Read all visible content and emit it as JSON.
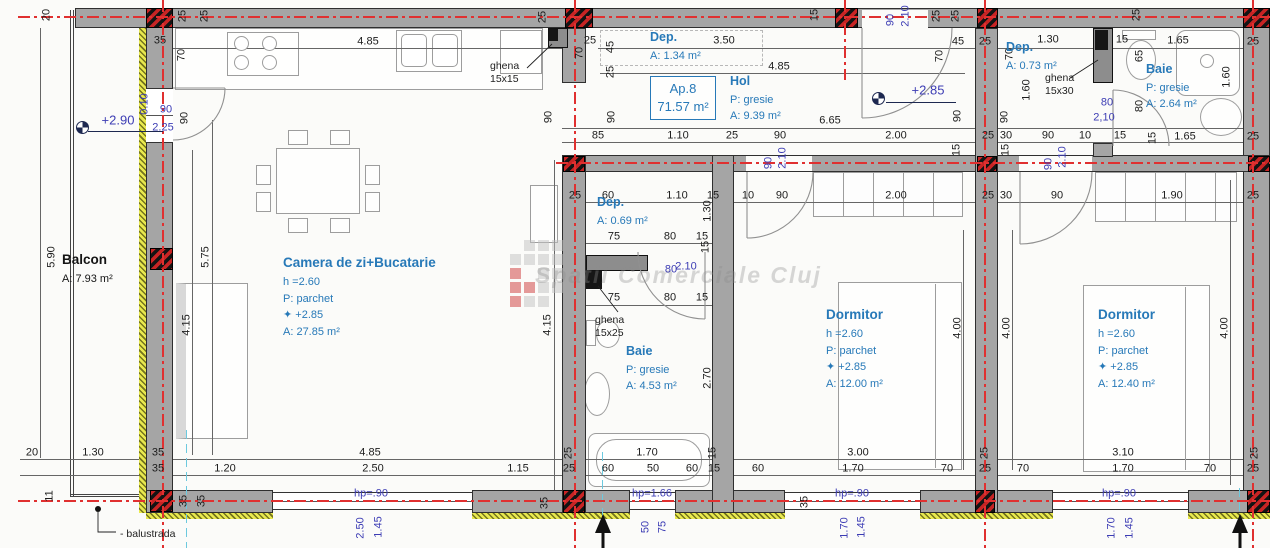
{
  "title": "Ap.8 apartment floor plan",
  "watermark": {
    "text": "Spatii Comerciale Cluj"
  },
  "ap_box": {
    "line1": "Ap.8",
    "line2": "71.57 m²"
  },
  "colors": {
    "axis_red": "#e03030",
    "annotation_blue": "#3c3cb4",
    "room_blue": "#2779b8",
    "wall_gray": "#a5a5a5",
    "insulation_yellow": "#e9e94e"
  },
  "room_blocks": [
    {
      "name": "balcon",
      "x": 62,
      "y": 250,
      "c": "blk",
      "lines": [
        "Balcon",
        "A: 7.93 m²"
      ]
    },
    {
      "name": "camera-de-zi",
      "x": 283,
      "y": 253,
      "c": "",
      "lines": [
        "Camera de zi+Bucatarie",
        "h =2.60",
        "P: parchet",
        "✦ +2.85",
        "A: 27.85 m²"
      ]
    },
    {
      "name": "dep-1",
      "x": 650,
      "y": 28,
      "c": "dep",
      "lines": [
        "Dep.",
        "A: 1.34 m²"
      ]
    },
    {
      "name": "hol",
      "x": 730,
      "y": 72,
      "c": "dep",
      "lines": [
        "Hol",
        "P: gresie",
        "A: 9.39 m²"
      ]
    },
    {
      "name": "dep-2",
      "x": 597,
      "y": 193,
      "c": "dep",
      "lines": [
        "Dep.",
        "A: 0.69 m²"
      ]
    },
    {
      "name": "baie-1",
      "x": 626,
      "y": 342,
      "c": "dep",
      "lines": [
        "Baie",
        "P: gresie",
        "A: 4.53 m²"
      ]
    },
    {
      "name": "dormitor-1",
      "x": 826,
      "y": 305,
      "c": "",
      "lines": [
        "Dormitor",
        "h =2.60",
        "P: parchet",
        "✦ +2.85",
        "A: 12.00 m²"
      ]
    },
    {
      "name": "dormitor-2",
      "x": 1098,
      "y": 305,
      "c": "",
      "lines": [
        "Dormitor",
        "h =2.60",
        "P: parchet",
        "✦ +2.85",
        "A: 12.40 m²"
      ]
    },
    {
      "name": "dep-3",
      "x": 1006,
      "y": 38,
      "c": "dep",
      "lines": [
        "Dep.",
        "A: 0.73 m²"
      ]
    },
    {
      "name": "baie-2",
      "x": 1146,
      "y": 60,
      "c": "dep",
      "lines": [
        "Baie",
        "P: gresie",
        "A: 2.64 m²"
      ]
    },
    {
      "name": "ghena-1",
      "x": 490,
      "y": 60,
      "c": "sm",
      "lines": [
        "ghena",
        "15x15"
      ]
    },
    {
      "name": "ghena-2",
      "x": 1045,
      "y": 72,
      "c": "sm",
      "lines": [
        "ghena",
        "15x30"
      ]
    },
    {
      "name": "ghena-3",
      "x": 595,
      "y": 314,
      "c": "sm",
      "lines": [
        "ghena",
        "15x25"
      ]
    },
    {
      "name": "balustrada",
      "x": 120,
      "y": 528,
      "c": "blk sm",
      "lines": [
        "- balustrada"
      ]
    }
  ],
  "labels": [
    {
      "t": "20",
      "x": 47,
      "y": 15,
      "c": "rot"
    },
    {
      "t": "25",
      "x": 183,
      "y": 16,
      "c": "rot"
    },
    {
      "t": "25",
      "x": 205,
      "y": 16,
      "c": "rot"
    },
    {
      "t": "35",
      "x": 160,
      "y": 41,
      "c": ""
    },
    {
      "t": "70",
      "x": 182,
      "y": 55,
      "c": "rot"
    },
    {
      "t": "+2.90",
      "x": 118,
      "y": 120,
      "c": "blue big"
    },
    {
      "t": "90",
      "x": 166,
      "y": 110,
      "c": "blue"
    },
    {
      "t": "2.25",
      "x": 163,
      "y": 128,
      "c": "blue"
    },
    {
      "t": "0.10",
      "x": 145,
      "y": 104,
      "c": "blue rot"
    },
    {
      "t": "90",
      "x": 185,
      "y": 118,
      "c": "rot"
    },
    {
      "t": "5.90",
      "x": 52,
      "y": 257,
      "c": "rot"
    },
    {
      "t": "5.75",
      "x": 206,
      "y": 257,
      "c": "rot"
    },
    {
      "t": "4.15",
      "x": 187,
      "y": 325,
      "c": "rot"
    },
    {
      "t": "4.15",
      "x": 548,
      "y": 325,
      "c": "rot"
    },
    {
      "t": "4.85",
      "x": 368,
      "y": 42,
      "c": ""
    },
    {
      "t": "25",
      "x": 543,
      "y": 17,
      "c": "rot"
    },
    {
      "t": "25",
      "x": 590,
      "y": 41,
      "c": ""
    },
    {
      "t": "45",
      "x": 611,
      "y": 47,
      "c": "rot"
    },
    {
      "t": "25",
      "x": 611,
      "y": 72,
      "c": "rot"
    },
    {
      "t": "70",
      "x": 580,
      "y": 53,
      "c": "rot"
    },
    {
      "t": "90",
      "x": 549,
      "y": 117,
      "c": "rot"
    },
    {
      "t": "90",
      "x": 612,
      "y": 117,
      "c": "rot"
    },
    {
      "t": "3.50",
      "x": 724,
      "y": 41,
      "c": ""
    },
    {
      "t": "4.85",
      "x": 779,
      "y": 67,
      "c": ""
    },
    {
      "t": "15",
      "x": 815,
      "y": 15,
      "c": "rot"
    },
    {
      "t": "90",
      "x": 891,
      "y": 20,
      "c": "blue rot"
    },
    {
      "t": "2.10",
      "x": 906,
      "y": 16,
      "c": "blue rot"
    },
    {
      "t": "6.65",
      "x": 830,
      "y": 121,
      "c": ""
    },
    {
      "t": "+2.85",
      "x": 928,
      "y": 90,
      "c": "blue big"
    },
    {
      "t": "25",
      "x": 937,
      "y": 16,
      "c": "rot"
    },
    {
      "t": "25",
      "x": 956,
      "y": 16,
      "c": "rot"
    },
    {
      "t": "45",
      "x": 958,
      "y": 42,
      "c": ""
    },
    {
      "t": "25",
      "x": 985,
      "y": 42,
      "c": ""
    },
    {
      "t": "70",
      "x": 940,
      "y": 56,
      "c": "rot"
    },
    {
      "t": "70",
      "x": 1010,
      "y": 54,
      "c": "rot"
    },
    {
      "t": "1.30",
      "x": 1048,
      "y": 40,
      "c": ""
    },
    {
      "t": "15",
      "x": 1122,
      "y": 40,
      "c": ""
    },
    {
      "t": "1.65",
      "x": 1178,
      "y": 41,
      "c": ""
    },
    {
      "t": "25",
      "x": 1253,
      "y": 42,
      "c": ""
    },
    {
      "t": "25",
      "x": 1137,
      "y": 15,
      "c": "rot"
    },
    {
      "t": "65",
      "x": 1140,
      "y": 56,
      "c": "rot"
    },
    {
      "t": "1.60",
      "x": 1227,
      "y": 77,
      "c": "rot"
    },
    {
      "t": "1.60",
      "x": 1027,
      "y": 90,
      "c": "rot"
    },
    {
      "t": "90",
      "x": 958,
      "y": 116,
      "c": "rot"
    },
    {
      "t": "90",
      "x": 1005,
      "y": 117,
      "c": "rot"
    },
    {
      "t": "80",
      "x": 1107,
      "y": 103,
      "c": "blue"
    },
    {
      "t": "2,10",
      "x": 1104,
      "y": 118,
      "c": "blue"
    },
    {
      "t": "80",
      "x": 1140,
      "y": 106,
      "c": "rot"
    },
    {
      "t": "15",
      "x": 1153,
      "y": 138,
      "c": "rot"
    },
    {
      "t": "25",
      "x": 988,
      "y": 136,
      "c": ""
    },
    {
      "t": "30",
      "x": 1006,
      "y": 136,
      "c": ""
    },
    {
      "t": "90",
      "x": 1048,
      "y": 136,
      "c": ""
    },
    {
      "t": "10",
      "x": 1085,
      "y": 136,
      "c": ""
    },
    {
      "t": "15",
      "x": 1120,
      "y": 136,
      "c": ""
    },
    {
      "t": "1.65",
      "x": 1185,
      "y": 137,
      "c": ""
    },
    {
      "t": "25",
      "x": 1253,
      "y": 137,
      "c": ""
    },
    {
      "t": "85",
      "x": 598,
      "y": 136,
      "c": ""
    },
    {
      "t": "1.10",
      "x": 678,
      "y": 136,
      "c": ""
    },
    {
      "t": "25",
      "x": 732,
      "y": 136,
      "c": ""
    },
    {
      "t": "90",
      "x": 780,
      "y": 136,
      "c": ""
    },
    {
      "t": "2.00",
      "x": 896,
      "y": 136,
      "c": ""
    },
    {
      "t": "25",
      "x": 575,
      "y": 196,
      "c": ""
    },
    {
      "t": "60",
      "x": 608,
      "y": 196,
      "c": ""
    },
    {
      "t": "1.10",
      "x": 677,
      "y": 196,
      "c": ""
    },
    {
      "t": "15",
      "x": 713,
      "y": 196,
      "c": ""
    },
    {
      "t": "10",
      "x": 748,
      "y": 196,
      "c": ""
    },
    {
      "t": "90",
      "x": 782,
      "y": 196,
      "c": ""
    },
    {
      "t": "2.00",
      "x": 896,
      "y": 196,
      "c": ""
    },
    {
      "t": "15",
      "x": 957,
      "y": 150,
      "c": "rot"
    },
    {
      "t": "15",
      "x": 1006,
      "y": 150,
      "c": "rot"
    },
    {
      "t": "25",
      "x": 988,
      "y": 196,
      "c": ""
    },
    {
      "t": "30",
      "x": 1006,
      "y": 196,
      "c": ""
    },
    {
      "t": "90",
      "x": 1057,
      "y": 196,
      "c": ""
    },
    {
      "t": "1.90",
      "x": 1172,
      "y": 196,
      "c": ""
    },
    {
      "t": "25",
      "x": 1253,
      "y": 196,
      "c": ""
    },
    {
      "t": "90",
      "x": 769,
      "y": 163,
      "c": "blue rot"
    },
    {
      "t": "2.10",
      "x": 783,
      "y": 158,
      "c": "blue rot"
    },
    {
      "t": "90",
      "x": 1049,
      "y": 164,
      "c": "blue rot"
    },
    {
      "t": "2.10",
      "x": 1063,
      "y": 157,
      "c": "blue rot"
    },
    {
      "t": "1.30",
      "x": 708,
      "y": 211,
      "c": "rot"
    },
    {
      "t": "15",
      "x": 706,
      "y": 247,
      "c": "rot"
    },
    {
      "t": "75",
      "x": 614,
      "y": 237,
      "c": ""
    },
    {
      "t": "80",
      "x": 670,
      "y": 237,
      "c": ""
    },
    {
      "t": "15",
      "x": 702,
      "y": 237,
      "c": ""
    },
    {
      "t": "80",
      "x": 671,
      "y": 270,
      "c": "blue"
    },
    {
      "t": "2.10",
      "x": 686,
      "y": 267,
      "c": "blue"
    },
    {
      "t": "75",
      "x": 614,
      "y": 298,
      "c": ""
    },
    {
      "t": "80",
      "x": 670,
      "y": 298,
      "c": ""
    },
    {
      "t": "15",
      "x": 702,
      "y": 298,
      "c": ""
    },
    {
      "t": "2.70",
      "x": 708,
      "y": 378,
      "c": "rot"
    },
    {
      "t": "4.00",
      "x": 958,
      "y": 328,
      "c": "rot"
    },
    {
      "t": "4.00",
      "x": 1007,
      "y": 328,
      "c": "rot"
    },
    {
      "t": "4.00",
      "x": 1225,
      "y": 328,
      "c": "rot"
    },
    {
      "t": "20",
      "x": 32,
      "y": 453,
      "c": ""
    },
    {
      "t": "1.30",
      "x": 93,
      "y": 453,
      "c": ""
    },
    {
      "t": "35",
      "x": 158,
      "y": 453,
      "c": ""
    },
    {
      "t": "35",
      "x": 158,
      "y": 469,
      "c": ""
    },
    {
      "t": "1.20",
      "x": 225,
      "y": 469,
      "c": ""
    },
    {
      "t": "11",
      "x": 50,
      "y": 496,
      "c": "rot"
    },
    {
      "t": "35",
      "x": 184,
      "y": 501,
      "c": "rot"
    },
    {
      "t": "35",
      "x": 202,
      "y": 501,
      "c": "rot"
    },
    {
      "t": "4.85",
      "x": 370,
      "y": 453,
      "c": ""
    },
    {
      "t": "25",
      "x": 569,
      "y": 453,
      "c": "rot"
    },
    {
      "t": "1.70",
      "x": 647,
      "y": 453,
      "c": ""
    },
    {
      "t": "15",
      "x": 713,
      "y": 453,
      "c": "rot"
    },
    {
      "t": "3.00",
      "x": 858,
      "y": 453,
      "c": ""
    },
    {
      "t": "25",
      "x": 985,
      "y": 453,
      "c": "rot"
    },
    {
      "t": "3.10",
      "x": 1123,
      "y": 453,
      "c": ""
    },
    {
      "t": "25",
      "x": 1255,
      "y": 453,
      "c": "rot"
    },
    {
      "t": "2.50",
      "x": 373,
      "y": 469,
      "c": ""
    },
    {
      "t": "1.15",
      "x": 518,
      "y": 469,
      "c": ""
    },
    {
      "t": "25",
      "x": 569,
      "y": 469,
      "c": ""
    },
    {
      "t": "60",
      "x": 608,
      "y": 469,
      "c": ""
    },
    {
      "t": "50",
      "x": 653,
      "y": 469,
      "c": ""
    },
    {
      "t": "60",
      "x": 692,
      "y": 469,
      "c": ""
    },
    {
      "t": "15",
      "x": 714,
      "y": 469,
      "c": ""
    },
    {
      "t": "60",
      "x": 758,
      "y": 469,
      "c": ""
    },
    {
      "t": "1.70",
      "x": 853,
      "y": 469,
      "c": ""
    },
    {
      "t": "70",
      "x": 947,
      "y": 469,
      "c": ""
    },
    {
      "t": "25",
      "x": 985,
      "y": 469,
      "c": ""
    },
    {
      "t": "70",
      "x": 1023,
      "y": 469,
      "c": ""
    },
    {
      "t": "1.70",
      "x": 1123,
      "y": 469,
      "c": ""
    },
    {
      "t": "70",
      "x": 1210,
      "y": 469,
      "c": ""
    },
    {
      "t": "25",
      "x": 1253,
      "y": 469,
      "c": ""
    },
    {
      "t": "35",
      "x": 545,
      "y": 503,
      "c": "rot"
    },
    {
      "t": "35",
      "x": 805,
      "y": 502,
      "c": "rot"
    },
    {
      "t": "hp=.90",
      "x": 371,
      "y": 494,
      "c": "blue"
    },
    {
      "t": "hp=1.66",
      "x": 652,
      "y": 494,
      "c": "blue"
    },
    {
      "t": "hp=.90",
      "x": 852,
      "y": 494,
      "c": "blue"
    },
    {
      "t": "hp=.90",
      "x": 1119,
      "y": 494,
      "c": "blue"
    },
    {
      "t": "2.50",
      "x": 361,
      "y": 528,
      "c": "blue rot"
    },
    {
      "t": "1.45",
      "x": 379,
      "y": 527,
      "c": "blue rot"
    },
    {
      "t": "50",
      "x": 646,
      "y": 527,
      "c": "blue rot"
    },
    {
      "t": "75",
      "x": 663,
      "y": 527,
      "c": "blue rot"
    },
    {
      "t": "1.70",
      "x": 845,
      "y": 528,
      "c": "blue rot"
    },
    {
      "t": "1.45",
      "x": 862,
      "y": 527,
      "c": "blue rot"
    },
    {
      "t": "1.70",
      "x": 1112,
      "y": 528,
      "c": "blue rot"
    },
    {
      "t": "1.45",
      "x": 1130,
      "y": 528,
      "c": "blue rot"
    }
  ]
}
